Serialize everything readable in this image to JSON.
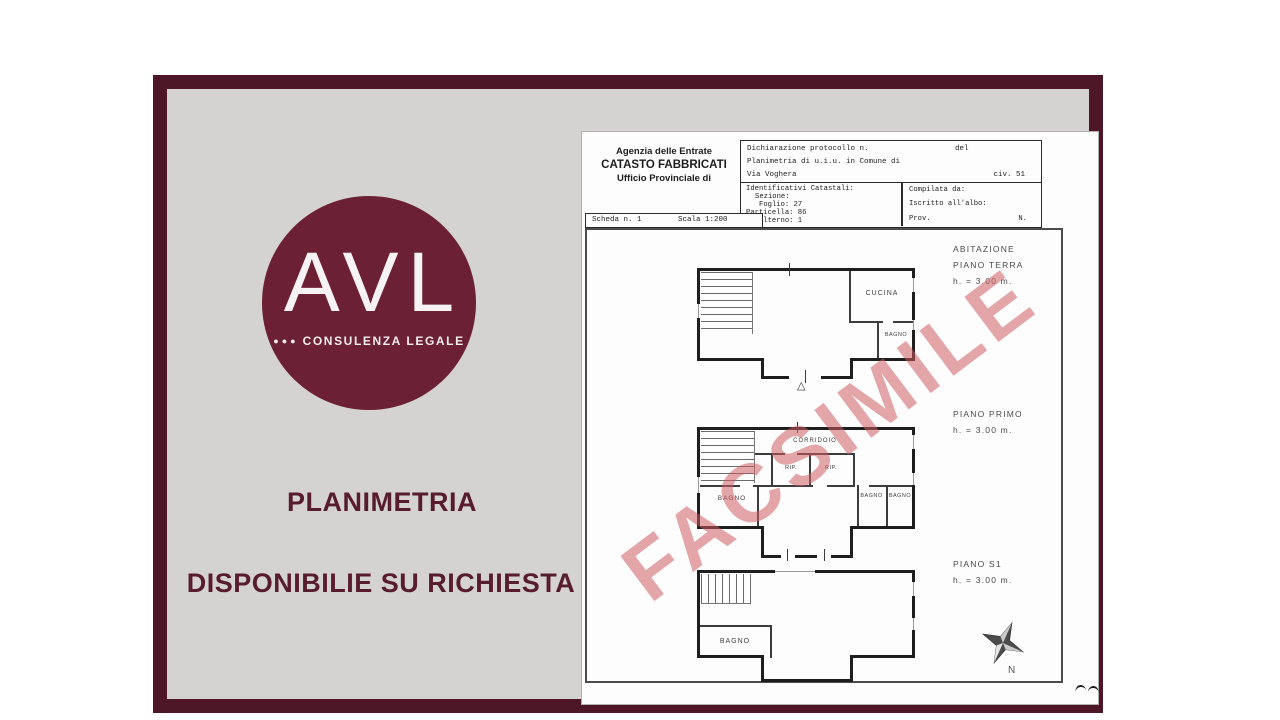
{
  "colors": {
    "frame": "#4e1727",
    "panel_background": "#d5d3d2",
    "logo_background": "#6b2034",
    "accent_text": "#571c2e",
    "watermark": "#ce5c63"
  },
  "brand": {
    "name": "AVL",
    "dots": "●●●",
    "subtitle": "CONSULENZA LEGALE"
  },
  "panel": {
    "title": "PLANIMETRIA",
    "subtitle": "DISPONIBILIE SU RICHIESTA"
  },
  "document": {
    "agency": {
      "line1": "Agenzia delle Entrate",
      "line2": "CATASTO FABBRICATI",
      "line3": "Ufficio Provinciale di"
    },
    "protocol": {
      "label": "Dichiarazione protocollo n.",
      "del": "del",
      "planimetria_line": "Planimetria di u.i.u. in Comune di",
      "address": "Via Voghera",
      "civ": "civ. 51"
    },
    "catasto": {
      "title": "Identificativi Catastali:",
      "sezione": "Sezione:",
      "foglio": "Foglio: 27",
      "particella": "Particella: 86",
      "subalterno": "Subalterno: 1"
    },
    "compiler": {
      "compilata": "Compilata da:",
      "iscritto": "Iscritto all'albo:",
      "prov": "Prov.",
      "n": "N."
    },
    "scheda": {
      "number": "Scheda n. 1",
      "scala": "Scala 1:200"
    },
    "watermark": "FACSIMILE",
    "plans": {
      "terra": {
        "title1": "ABITAZIONE",
        "title2": "PIANO TERRA",
        "height": "h. = 3.00 m.",
        "cucina": "CUCINA",
        "bagno": "BAGNO",
        "door_mark": "△"
      },
      "primo": {
        "title1": "PIANO PRIMO",
        "height": "h. = 3.00 m.",
        "corridoio": "CORRIDOIO",
        "rip1": "RIP.",
        "rip2": "RIP.",
        "bagno_left": "BAGNO",
        "bagno_r1": "BAGNO",
        "bagno_r2": "BAGNO"
      },
      "s1": {
        "title1": "PIANO S1",
        "height": "h. = 3.00 m.",
        "bagno": "BAGNO"
      }
    },
    "compass_label": "N"
  }
}
